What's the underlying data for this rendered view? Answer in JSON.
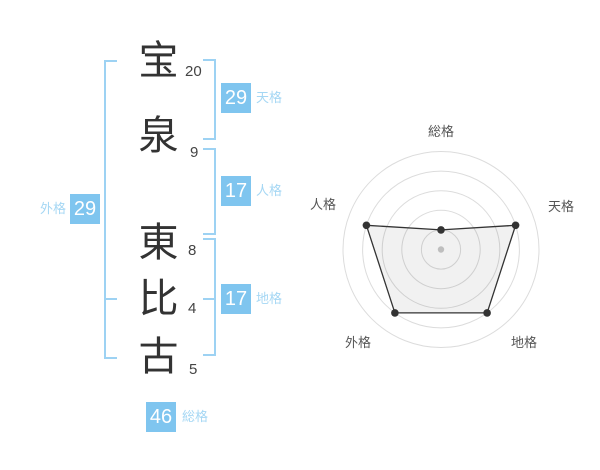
{
  "name_chart": {
    "characters": [
      {
        "char": "宝",
        "strokes": "20"
      },
      {
        "char": "泉",
        "strokes": "9"
      },
      {
        "char": "東",
        "strokes": "8"
      },
      {
        "char": "比",
        "strokes": "4"
      },
      {
        "char": "古",
        "strokes": "5"
      }
    ],
    "badges": {
      "tenkaku": {
        "label": "天格",
        "value": "29"
      },
      "jinkaku": {
        "label": "人格",
        "value": "17"
      },
      "chikaku": {
        "label": "地格",
        "value": "17"
      },
      "gaikaku": {
        "label": "外格",
        "value": "29"
      },
      "soukaku": {
        "label": "総格",
        "value": "46"
      }
    }
  },
  "colors": {
    "badge_blue": "#7fc5ef",
    "label_blue": "#a5d7f4",
    "bracket_blue": "#9dd2f3",
    "name_text": "#333333",
    "stroke_text": "#444444",
    "radar_grid": "#dcdcdc",
    "radar_line": "#333333",
    "radar_label": "#555555"
  },
  "chart_data": {
    "type": "radar",
    "axes": [
      "総格",
      "天格",
      "地格",
      "外格",
      "人格"
    ],
    "values": [
      1,
      4,
      4,
      4,
      4
    ],
    "max": 5,
    "rings": 5,
    "grid_shape": "concentric-circles",
    "start_axis": "top",
    "direction": "clockwise",
    "legend": false
  }
}
